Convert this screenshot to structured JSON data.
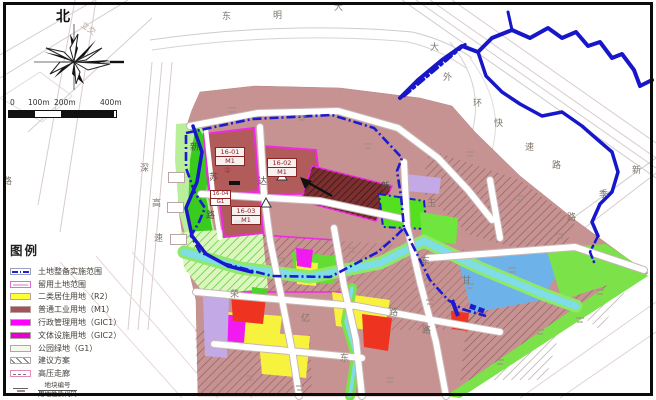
{
  "map": {
    "compass_north": "北",
    "scale_ticks": [
      "0",
      "100m",
      "200m",
      "400m"
    ],
    "interchange_label": "立交",
    "phase_mark": "②"
  },
  "legend": {
    "title": "图例",
    "items": [
      {
        "label": "土地整备实施范围",
        "swatch": "boundary-dashdot-line"
      },
      {
        "label": "留用土地范围",
        "swatch": "retained-land-outline"
      },
      {
        "label": "二类居住用地（R2）",
        "swatch": "yellow-fill"
      },
      {
        "label": "普通工业用地（M1）",
        "swatch": "brown-red-fill"
      },
      {
        "label": "行政管理用地（GIC1）",
        "swatch": "magenta-fill"
      },
      {
        "label": "文体设施用地（GIC2）",
        "swatch": "magenta-fill-2"
      },
      {
        "label": "公园绿地（G1）",
        "swatch": "pale-fill"
      },
      {
        "label": "建议方案",
        "swatch": "diagonal-hatch"
      },
      {
        "label": "高压走廊",
        "swatch": "hv-corridor-box"
      }
    ],
    "block_note": {
      "numerator": "地块编号",
      "denominator": "用地性质代码"
    }
  },
  "parcels": [
    {
      "id": "16-01",
      "code": "M1"
    },
    {
      "id": "16-02",
      "code": "M1"
    },
    {
      "id": "16-03",
      "code": "M1"
    },
    {
      "id": "16-04",
      "code": "G1"
    }
  ],
  "road_labels": [
    {
      "t": "东",
      "x": 222,
      "y": 12
    },
    {
      "t": "明",
      "x": 273,
      "y": 11
    },
    {
      "t": "大",
      "x": 334,
      "y": 3
    },
    {
      "t": "大",
      "x": 430,
      "y": 43
    },
    {
      "t": "外",
      "x": 443,
      "y": 73
    },
    {
      "t": "环",
      "x": 473,
      "y": 99
    },
    {
      "t": "快",
      "x": 494,
      "y": 119
    },
    {
      "t": "速",
      "x": 525,
      "y": 143
    },
    {
      "t": "路",
      "x": 552,
      "y": 161
    },
    {
      "t": "新",
      "x": 632,
      "y": 166
    },
    {
      "t": "季",
      "x": 599,
      "y": 190
    },
    {
      "t": "路",
      "x": 567,
      "y": 213
    },
    {
      "t": "深",
      "x": 140,
      "y": 164
    },
    {
      "t": "高",
      "x": 152,
      "y": 199
    },
    {
      "t": "速",
      "x": 154,
      "y": 234
    },
    {
      "t": "路",
      "x": 3,
      "y": 177
    },
    {
      "t": "新",
      "x": 190,
      "y": 143
    },
    {
      "t": "苏",
      "x": 209,
      "y": 173
    },
    {
      "t": "路",
      "x": 206,
      "y": 211
    },
    {
      "t": "达",
      "x": 258,
      "y": 177
    },
    {
      "t": "新",
      "x": 381,
      "y": 182
    },
    {
      "t": "玉",
      "x": 427,
      "y": 199
    },
    {
      "t": "荣",
      "x": 230,
      "y": 290
    },
    {
      "t": "亿",
      "x": 301,
      "y": 314
    },
    {
      "t": "路",
      "x": 389,
      "y": 308
    },
    {
      "t": "东",
      "x": 340,
      "y": 354
    },
    {
      "t": "路",
      "x": 422,
      "y": 326
    },
    {
      "t": "甘",
      "x": 462,
      "y": 276
    },
    {
      "t": "东",
      "x": 421,
      "y": 257
    }
  ],
  "colors": {
    "boundary_blue": "#1c1ccd",
    "river_blue": "#1717c9",
    "canal_cyan": "#7fdde8",
    "retained_magenta": "#ee2ae2",
    "residential_yellow_R2": "#f7f23d",
    "industrial_brown_M1": "#b25b5b",
    "dark_industrial_proposal": "#7c2f2f",
    "gic_magenta": "#f11af1",
    "park_green_G1": "#64dd33",
    "water_parcel_blue": "#6db3ea",
    "lavender_parcel": "#c3aae6",
    "red_parcel": "#ee3420",
    "base_parcel_mauve": "#c79292"
  }
}
